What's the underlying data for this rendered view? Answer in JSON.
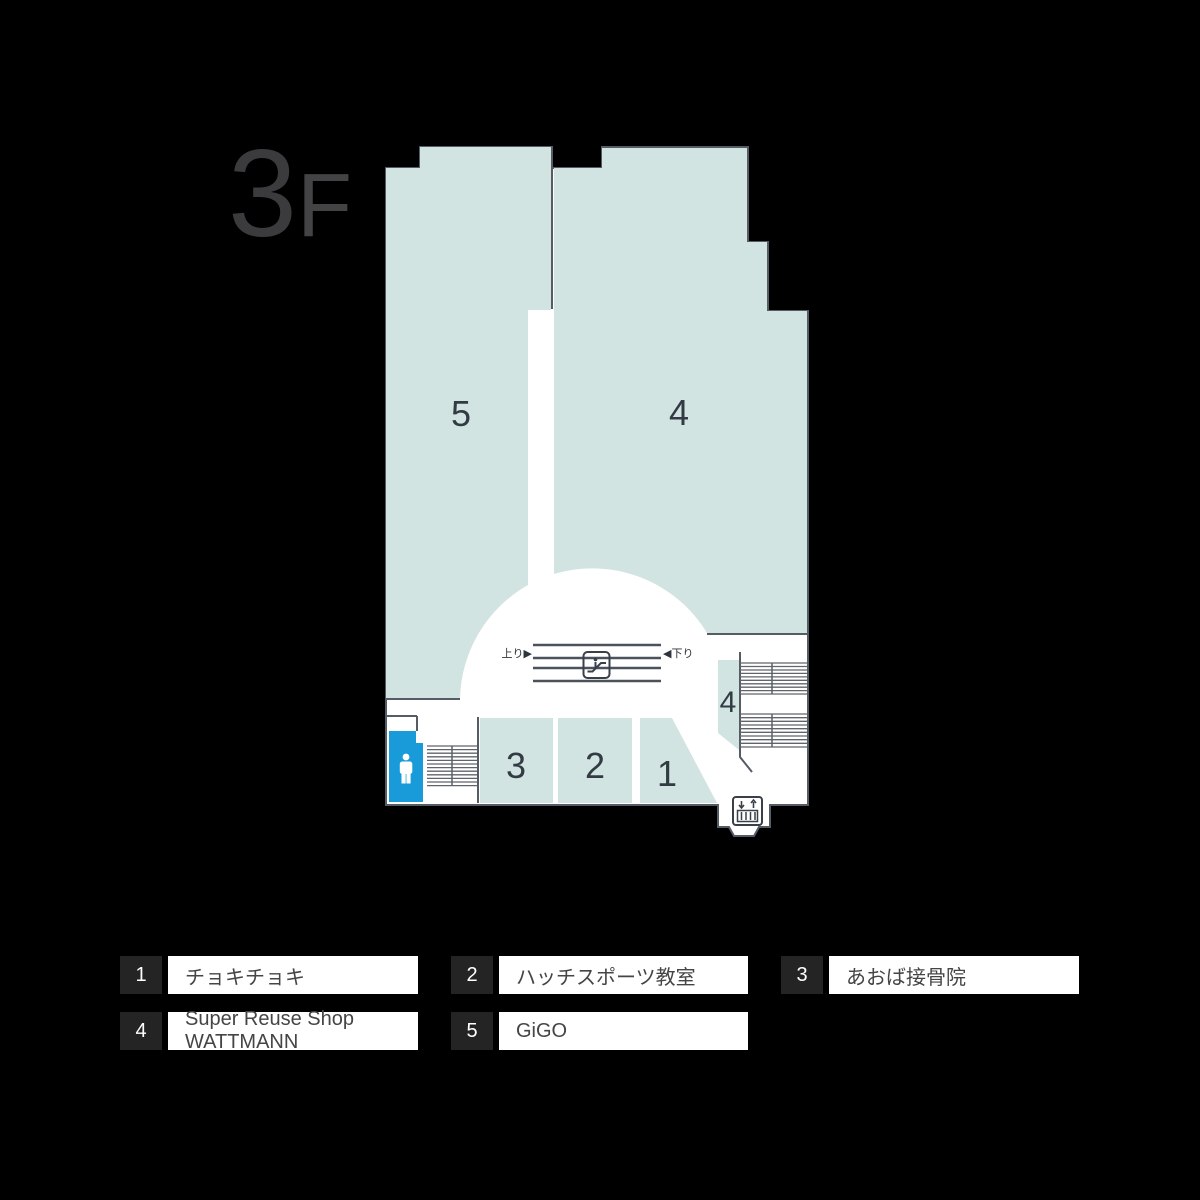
{
  "floor": {
    "number": "3",
    "suffix": "F"
  },
  "map": {
    "areas": [
      {
        "label": "5"
      },
      {
        "label": "4"
      },
      {
        "label": "3"
      },
      {
        "label": "2"
      },
      {
        "label": "1"
      },
      {
        "label": "4"
      }
    ],
    "escalator": {
      "up_label": "上り▶",
      "down_label": "◀下り"
    },
    "colors": {
      "area_fill": "#d2e4e2",
      "outline": "#565c66",
      "toilet_blue": "#189bd8",
      "background": "#000000"
    }
  },
  "legend": {
    "items": [
      {
        "number": "1",
        "label": "チョキチョキ"
      },
      {
        "number": "2",
        "label": "ハッチスポーツ教室"
      },
      {
        "number": "3",
        "label": "あおば接骨院"
      },
      {
        "number": "4",
        "label": "Super Reuse Shop WATTMANN"
      },
      {
        "number": "5",
        "label": "GiGO"
      }
    ]
  }
}
